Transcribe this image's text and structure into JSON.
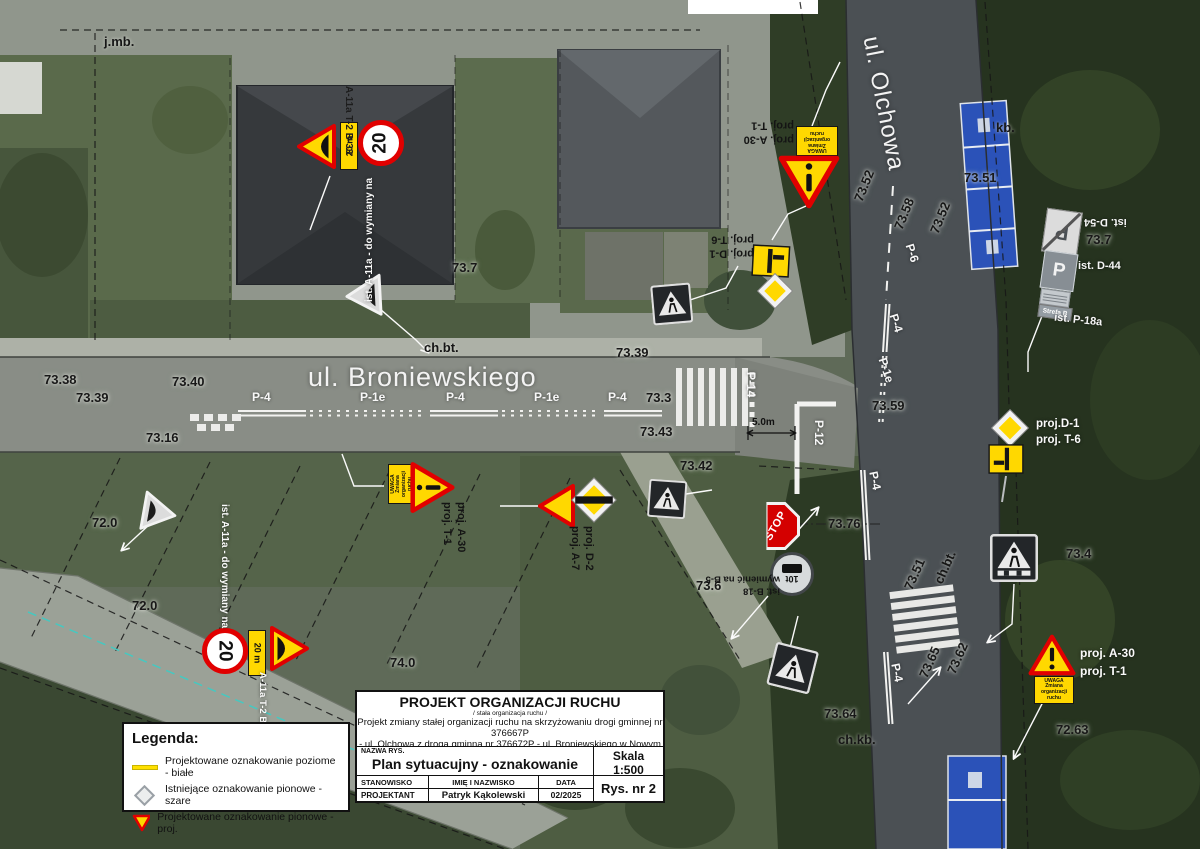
{
  "streets": {
    "broniewskiego": "ul. Broniewskiego",
    "olchowa": "ul. Olchowa"
  },
  "signs": {
    "speed_limit_value": "20",
    "distance_plate": "20 m",
    "uwaga_plate": "UWAGA\nZmiana\norganizacji\nruchu",
    "stop": "STOP",
    "weight_plate": "10t",
    "parking_glyph": "P",
    "strefa_plate": "Strefa B",
    "clusters": {
      "top_left_labels": "A-11a T-2 B-33",
      "ist_a11a_top": "ist. A-11a - do wymiany na",
      "d1_t6_top": {
        "l1": "proj. D-1",
        "l2": "proj. T-6"
      },
      "a30_t1_top": {
        "l1": "proj. A-30",
        "l2": "proj. T-1"
      },
      "ist_stack": {
        "d54": "ist. D-54",
        "d44": "ist. D-44",
        "p18a": "ist. P-18a"
      },
      "d1_t6_right": {
        "l1": "proj.D-1",
        "l2": "proj. T-6"
      },
      "a30_t1_right": {
        "l1": "proj. A-30",
        "l2": "proj. T-1"
      },
      "a30_t1_mid": {
        "l1": "proj. A-30",
        "l2": "proj. T-1"
      },
      "d2_a7": {
        "l1": "proj. D-2",
        "l2": "proj. A-7"
      },
      "b18_note": {
        "l1": "ist. B-18",
        "l2": "wymienić na B-5"
      },
      "bottom_left_labels": "A-11a T-2 B-33",
      "ist_a11a_bottom": "ist. A-11a - do wymiany na"
    }
  },
  "annotations": {
    "dimension": "5.0m",
    "elevations": [
      {
        "t": "73.38",
        "x": 44,
        "y": 372
      },
      {
        "t": "73.39",
        "x": 76,
        "y": 390
      },
      {
        "t": "73.40",
        "x": 172,
        "y": 374
      },
      {
        "t": "73.16",
        "x": 146,
        "y": 430
      },
      {
        "t": "72.0",
        "x": 92,
        "y": 515
      },
      {
        "t": "72.0",
        "x": 132,
        "y": 598
      },
      {
        "t": "74.0",
        "x": 390,
        "y": 655
      },
      {
        "t": "73.7",
        "x": 452,
        "y": 260
      },
      {
        "t": "73.39",
        "x": 616,
        "y": 345
      },
      {
        "t": "73.3",
        "x": 646,
        "y": 390
      },
      {
        "t": "73.43",
        "x": 640,
        "y": 424
      },
      {
        "t": "73.42",
        "x": 680,
        "y": 458
      },
      {
        "t": "73.6",
        "x": 696,
        "y": 578
      },
      {
        "t": "73.51",
        "x": 964,
        "y": 170
      },
      {
        "t": "73.7",
        "x": 1086,
        "y": 232
      },
      {
        "t": "73.52",
        "x": 851,
        "y": 198,
        "r": -68
      },
      {
        "t": "73.58",
        "x": 891,
        "y": 226,
        "r": -68
      },
      {
        "t": "73.52",
        "x": 927,
        "y": 230,
        "r": -68
      },
      {
        "t": "73.59",
        "x": 872,
        "y": 398
      },
      {
        "t": "73.76",
        "x": 828,
        "y": 516
      },
      {
        "t": "73.51",
        "x": 901,
        "y": 586,
        "r": -66
      },
      {
        "t": "73.4",
        "x": 1066,
        "y": 546
      },
      {
        "t": "73.65",
        "x": 916,
        "y": 674,
        "r": -66
      },
      {
        "t": "73.62",
        "x": 944,
        "y": 670,
        "r": -66
      },
      {
        "t": "73.64",
        "x": 824,
        "y": 706
      },
      {
        "t": "72.63",
        "x": 1056,
        "y": 722
      }
    ],
    "markings": [
      {
        "t": "P-4",
        "x": 252,
        "y": 390
      },
      {
        "t": "P-1e",
        "x": 360,
        "y": 390
      },
      {
        "t": "P-4",
        "x": 446,
        "y": 390
      },
      {
        "t": "P-1e",
        "x": 534,
        "y": 390
      },
      {
        "t": "P-4",
        "x": 608,
        "y": 390
      },
      {
        "t": "P-14",
        "x": 758,
        "y": 372,
        "r": 90
      },
      {
        "t": "P-12",
        "x": 826,
        "y": 420,
        "r": 90
      },
      {
        "t": "P-6",
        "x": 916,
        "y": 242,
        "r": 72
      },
      {
        "t": "P-4",
        "x": 900,
        "y": 312,
        "r": 72
      },
      {
        "t": "P-1e",
        "x": 889,
        "y": 356,
        "r": 72
      },
      {
        "t": "P-4",
        "x": 880,
        "y": 470,
        "r": 78
      },
      {
        "t": "P-4",
        "x": 902,
        "y": 662,
        "r": 78
      }
    ],
    "surface_labels": [
      {
        "t": "j.mb.",
        "x": 104,
        "y": 34
      },
      {
        "t": "kb.",
        "x": 996,
        "y": 120
      },
      {
        "t": "ch.bt.",
        "x": 424,
        "y": 340
      },
      {
        "t": "ch.bt.",
        "x": 931,
        "y": 580,
        "r": -66
      },
      {
        "t": "ch.kb.",
        "x": 838,
        "y": 732
      }
    ]
  },
  "legend": {
    "title": "Legenda:",
    "items": [
      {
        "label": "Projektowane oznakowanie poziome - białe"
      },
      {
        "label": "Istniejące oznakowanie pionowe - szare"
      },
      {
        "label": "Projektowane oznakowanie pionowe - proj."
      }
    ]
  },
  "title_block": {
    "title": "PROJEKT ORGANIZACJI RUCHU",
    "subtitle": "/ stała organizacja ruchu /",
    "desc1": "Projekt zmiany stałej organizacji ruchu na skrzyżowaniu drogi gminnej nr 376667P",
    "desc2": "- ul. Olchowa z drogą gminną nr 376672P - ul. Broniewskiego w Nowym Tomyślu",
    "nazwa_label": "NAZWA RYS.",
    "drawing_name": "Plan sytuacujny - oznakowanie stałe",
    "skala_label": "Skala",
    "skala_value": "1:500",
    "col1": "STANOWISKO",
    "col2": "IMIĘ I NAZWISKO",
    "col3": "DATA",
    "role": "PROJEKTANT",
    "person": "Patryk Kąkolewski",
    "date": "02/2025",
    "rys": "Rys. nr 2"
  }
}
